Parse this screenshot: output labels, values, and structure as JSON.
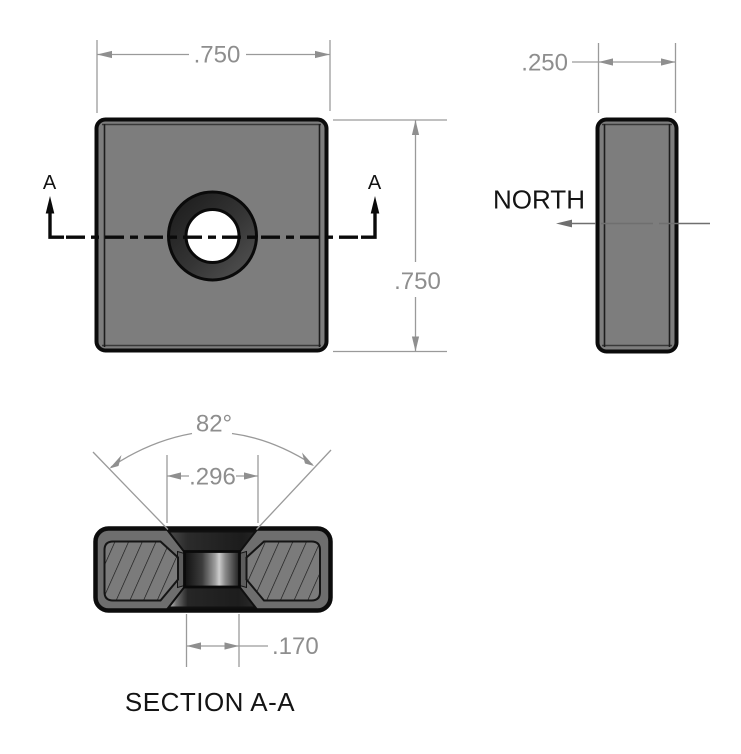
{
  "drawing": {
    "front_view": {
      "width_dim": ".750",
      "height_dim": ".750",
      "section_label_left": "A",
      "section_label_right": "A"
    },
    "side_view": {
      "thickness_dim": ".250",
      "pole_label": "NORTH"
    },
    "section_view": {
      "title": "SECTION A-A",
      "countersink_angle": "82°",
      "countersink_dia": ".296",
      "hole_dia": ".170"
    },
    "colors": {
      "body_gray": "#7d7d7d",
      "section_rim_gray": "#6e6e6e",
      "hatch_gray": "#7b7b7b",
      "outline_black": "#0b0b0b",
      "dimension_gray": "#8e8e8e",
      "hole_white": "#ffffff"
    }
  }
}
